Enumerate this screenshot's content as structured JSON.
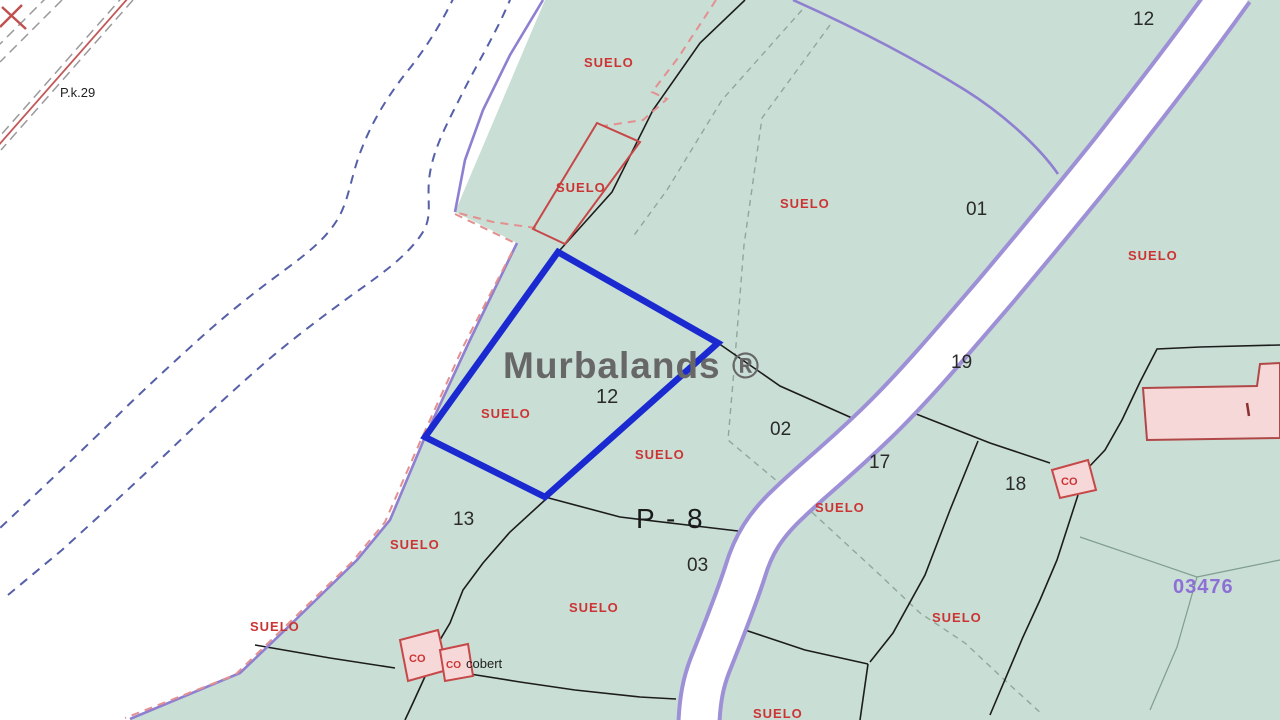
{
  "map": {
    "watermark": "Murbalands ®",
    "land_label": "SUELO",
    "sheet_code": "03476",
    "km_post_label": "P.k.29",
    "zone_label": "P - 8",
    "construction_label": "CO",
    "construction_name": "cobert",
    "parcel_numbers": {
      "road_top": "12",
      "p01": "01",
      "p19": "19",
      "p02": "02",
      "p17": "17",
      "p18": "18",
      "selected": "12",
      "p13": "13",
      "p03": "03"
    },
    "colors": {
      "parcel_fill": "#c9ded5",
      "selected_parcel": "#1a2ad0",
      "purple_boundary": "#8f7fd0",
      "road_casing": "#9e90d6",
      "road_fill": "#ffffff",
      "label_red": "#cc3434",
      "sheet_code_purple": "#8d6fd6",
      "building_fill": "#f7d8d8",
      "building_stroke": "#b04848",
      "stream_blue": "#5560a8",
      "watermark_gray": "#676767"
    }
  }
}
